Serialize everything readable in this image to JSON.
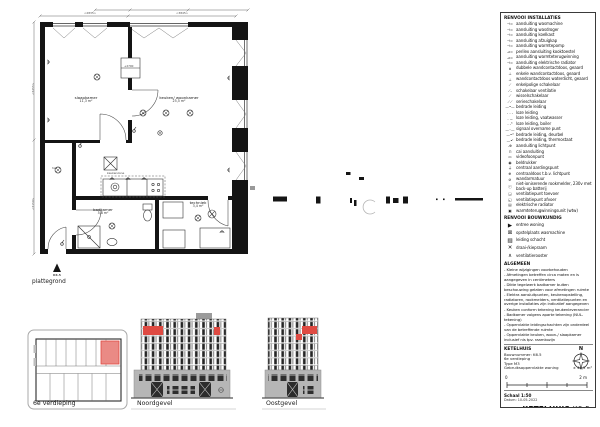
{
  "plan": {
    "label": "plattegrond",
    "entrance": "K6.5",
    "hal": "hal",
    "zone": "keukenzone",
    "level": "+2700",
    "rooms": [
      {
        "name": "slaapkamer",
        "area": "11,3 m²"
      },
      {
        "name": "keuken/ woonkamer",
        "area": "25,5 m²"
      },
      {
        "name": "badkamer",
        "area": "5,8 m²"
      },
      {
        "name": "techniek",
        "area": "3,4 m²"
      }
    ],
    "dims": {
      "top_left": "<2835>",
      "top_right": "<3845>",
      "left_upper": "<3255>",
      "left_lower": "<3150>"
    }
  },
  "views": {
    "overview": "6e verdieping",
    "north": "Noordgevel",
    "east": "Oostgevel"
  },
  "compass": {
    "n": "N"
  },
  "legend": {
    "title_installaties": "RENVOOI INSTALLATIES",
    "installaties": [
      {
        "sym": "⊣=",
        "label": "aansluiting wasmachine"
      },
      {
        "sym": "⊣=",
        "label": "aansluiting wasdroger"
      },
      {
        "sym": "⊣=",
        "label": "aansluiting koelkast"
      },
      {
        "sym": "⊣=",
        "label": "aansluiting afzuigkap"
      },
      {
        "sym": "⊣=",
        "label": "aansluiting warmtepomp"
      },
      {
        "sym": "⊿=",
        "label": "perilex aansluiting kooktoestel"
      },
      {
        "sym": "⊿=",
        "label": "aansluiting warmteterugwinning"
      },
      {
        "sym": "⊣=",
        "label": "aansluiting elektrische radiator"
      },
      {
        "sym": "⋔",
        "label": "dubbele wandcontactdoos, geaard"
      },
      {
        "sym": "⊥",
        "label": "enkele wandcontactdoos, geaard"
      },
      {
        "sym": "⊥",
        "label": "wandcontactdoos waterdicht, geaard"
      },
      {
        "sym": "⟋",
        "label": "enkelpolige schakelaar"
      },
      {
        "sym": "⟋ᵥ",
        "label": "schakelaar ventilatie"
      },
      {
        "sym": "⟋",
        "label": "wisselschakelaar"
      },
      {
        "sym": "⟋⟋",
        "label": "serieschakelaar"
      },
      {
        "sym": "—•—",
        "label": "bedrade leiding"
      },
      {
        "sym": "- - -",
        "label": "loze leiding"
      },
      {
        "sym": "- -ᵥ",
        "label": "loze leiding, vaatwasser"
      },
      {
        "sym": "- -ᵇ",
        "label": "loze leiding, boiler"
      },
      {
        "sym": "—◦—",
        "label": "signaal overname punt"
      },
      {
        "sym": "—•ᵈ",
        "label": "bedrade leiding, deurbel"
      },
      {
        "sym": "—•ᵗ",
        "label": "bedrade leiding, thermostaat"
      },
      {
        "sym": "-⊕",
        "label": "aansluiting lichtpunt"
      },
      {
        "sym": "⊓",
        "label": "cai aansluiting"
      },
      {
        "sym": "▭",
        "label": "videofoonpunt"
      },
      {
        "sym": "◉",
        "label": "beldrukker"
      },
      {
        "sym": "⏚",
        "label": "centraal aardingspunt"
      },
      {
        "sym": "⊕",
        "label": "centraaldoos t.b.v. lichtpunt"
      },
      {
        "sym": "⊘",
        "label": "wandarmatuur"
      },
      {
        "sym": "ⓡ",
        "label": "niet-ioniserende rookmelder, 230v met back-up batterij"
      },
      {
        "sym": "◲",
        "label": "ventilatiepunt toevoer"
      },
      {
        "sym": "◱",
        "label": "ventilatiepunt afvoer"
      },
      {
        "sym": "▤",
        "label": "elektrische radiator"
      },
      {
        "sym": "▣",
        "label": "warmteterugwinningsunit (wtw)"
      }
    ],
    "title_bouwkundig": "RENVOOI BOUWKUNDIG",
    "bouwkundig": [
      {
        "sym": "▶",
        "label": "entree woning"
      },
      {
        "sym": "⊠",
        "label": "opstelplaats wasmachine"
      },
      {
        "sym": "▨",
        "label": "leiding schacht"
      },
      {
        "sym": "✕",
        "label": "draai-/kiepraam"
      },
      {
        "sym": "∧",
        "label": "ventilatierooster"
      }
    ],
    "title_algemeen": "ALGEMEEN",
    "algemeen": [
      "- Kleine wijzigingen voorbehouden",
      "- Afmetingen betreffen circa maten en is aangegeven in centimeters",
      "- Dikte tegelwerk badkamer buiten beschouwing gelaten voor afmetingen ruimte",
      "- Elektra aansluitpunten, keukenopstelling, radiatoren, rookmelders, ventilatiepunten en overige installaties zijn indicatief aangegeven",
      "- Keuken conform tekening keukenleverancier",
      "- Badkamer volgens aparte tekening (NUL-tekening)",
      "- Oppervlakte leidingschachten zijn onderdeel van de betreffende ruimte",
      "- Oppervlakte keuken, woon-/ slaapkamer inclusief nis tpv. raamkozijn"
    ]
  },
  "project": {
    "name": "KETELHUIS",
    "bouwnummer": "Bouwnummer: K6.5",
    "verdieping": "6e verdieping",
    "type": "Type M3",
    "gbo_label": "Gebruiksoppervlakte woning",
    "gbo_value": "± 48,2 m²"
  },
  "scalebar": {
    "start": "0",
    "end": "2 m"
  },
  "titleblock": {
    "schaal": "Schaal 1:50",
    "datum": "Datum: 10-05-2022",
    "name": "KETELHUIS",
    "unit": "K6.5"
  },
  "colors": {
    "ink": "#141414",
    "highlight": "#df4a42",
    "highlight_light": "#ea8a85",
    "plinth": "#b6b6b6",
    "window_dark": "#2e2e2e",
    "line_gray": "#9c9c9c"
  }
}
